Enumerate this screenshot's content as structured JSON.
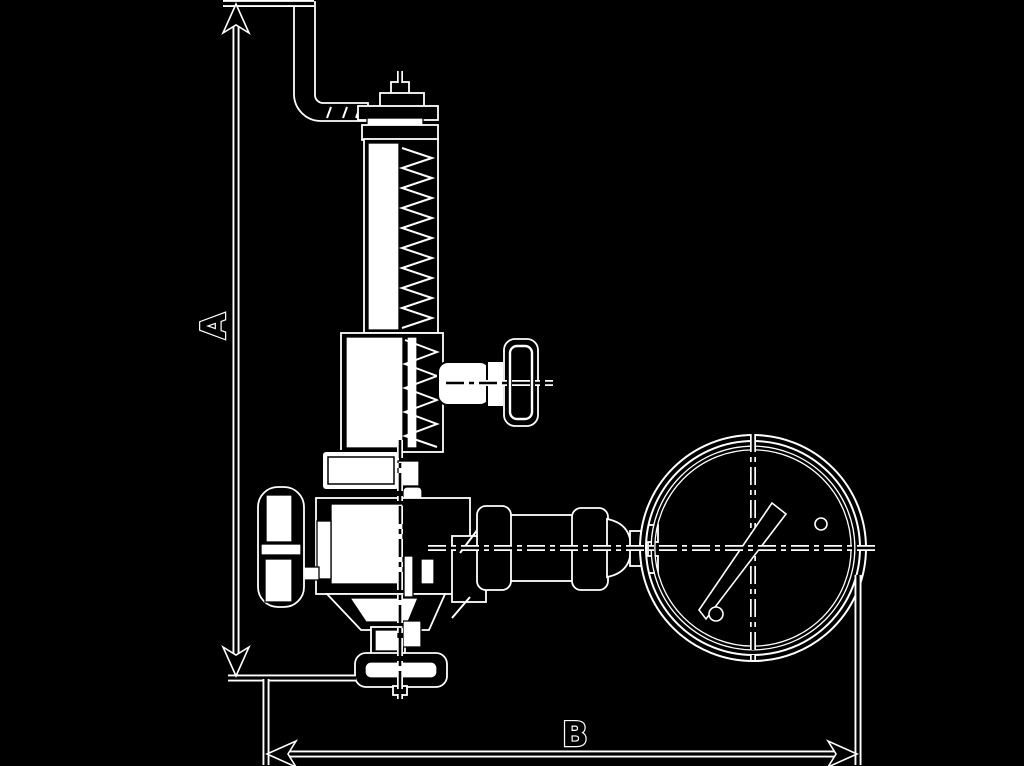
{
  "diagram": {
    "type": "technical-drawing",
    "subject": "safety-relief-valve-side-elevation-with-pressure-gauge",
    "background_color": "#000000",
    "ink_color": "#000000",
    "halo_color": "#ffffff",
    "fill_color": "#ffffff",
    "dimensions": {
      "vertical": {
        "label": "A"
      },
      "horizontal": {
        "label": "B"
      }
    },
    "parts": [
      "discharge-elbow-pipe",
      "bonnet-cap",
      "spring-bonnet",
      "spring",
      "test-knob",
      "gland-nut",
      "valve-body",
      "handwheel",
      "outlet-union-fittings",
      "pressure-gauge",
      "gauge-needle",
      "inlet-flange"
    ]
  }
}
